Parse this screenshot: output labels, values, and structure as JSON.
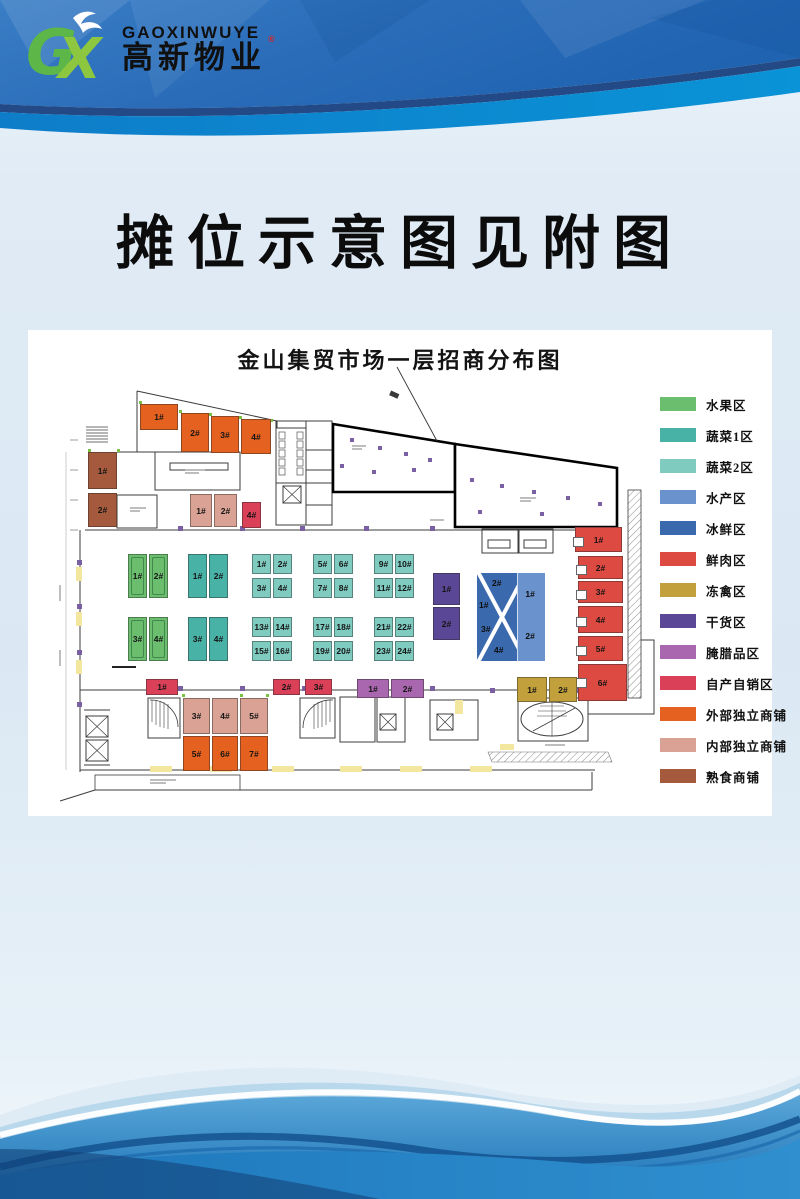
{
  "header": {
    "brand_en": "GAOXINWUYE",
    "brand_cn": "高新物业",
    "trademark": "®"
  },
  "page_title": "摊位示意图见附图",
  "plan": {
    "title": "金山集贸市场一层招商分布图",
    "zones": {
      "fruit": {
        "name": "水果区",
        "color": "#6cbe6f",
        "stalls": [
          "1#",
          "2#",
          "3#",
          "4#"
        ]
      },
      "veg1": {
        "name": "蔬菜1区",
        "color": "#49b2a6",
        "stalls": [
          "1#",
          "2#",
          "3#",
          "4#"
        ]
      },
      "veg2": {
        "name": "蔬菜2区",
        "color": "#7fcbc0",
        "stalls": [
          "1#",
          "2#",
          "3#",
          "4#",
          "5#",
          "6#",
          "7#",
          "8#",
          "9#",
          "10#",
          "11#",
          "12#",
          "13#",
          "14#",
          "15#",
          "16#",
          "17#",
          "18#",
          "19#",
          "20#",
          "21#",
          "22#",
          "23#",
          "24#"
        ]
      },
      "aquatic": {
        "name": "水产区",
        "color": "#6a93cd",
        "stalls": [
          "1#",
          "2#"
        ]
      },
      "icefresh": {
        "name": "冰鲜区",
        "color": "#3b69ad",
        "stalls": [
          "1#",
          "2#",
          "3#",
          "4#"
        ]
      },
      "meat": {
        "name": "鲜肉区",
        "color": "#dd4a41",
        "stalls": [
          "1#",
          "2#",
          "3#",
          "4#",
          "5#",
          "6#"
        ]
      },
      "poultry": {
        "name": "冻禽区",
        "color": "#c2a13c",
        "stalls": [
          "1#",
          "2#"
        ]
      },
      "dry": {
        "name": "干货区",
        "color": "#5a4795",
        "stalls": [
          "1#",
          "2#"
        ]
      },
      "cured": {
        "name": "腌腊品区",
        "color": "#a867ae",
        "stalls": [
          "1#",
          "2#"
        ]
      },
      "self": {
        "name": "自产自销区",
        "color": "#da4057",
        "stalls": [
          "1#",
          "2#",
          "3#",
          "4#"
        ]
      },
      "ext": {
        "name": "外部独立商铺",
        "color": "#e4611f",
        "stalls": [
          "1#",
          "2#",
          "3#",
          "4#",
          "5#",
          "6#",
          "7#"
        ]
      },
      "int": {
        "name": "内部独立商铺",
        "color": "#d9a294",
        "stalls": [
          "1#",
          "2#",
          "3#",
          "4#",
          "5#"
        ]
      },
      "cooked": {
        "name": "熟食商铺",
        "color": "#a55a3d",
        "stalls": [
          "1#",
          "2#"
        ]
      }
    }
  },
  "legend": {
    "items": [
      {
        "label": "水果区",
        "color": "#6cbe6f"
      },
      {
        "label": "蔬菜1区",
        "color": "#49b2a6"
      },
      {
        "label": "蔬菜2区",
        "color": "#7fcbc0"
      },
      {
        "label": "水产区",
        "color": "#6a93cd"
      },
      {
        "label": "冰鲜区",
        "color": "#3b69ad"
      },
      {
        "label": "鲜肉区",
        "color": "#dd4a41"
      },
      {
        "label": "冻禽区",
        "color": "#c2a13c"
      },
      {
        "label": "干货区",
        "color": "#5a4795"
      },
      {
        "label": "腌腊品区",
        "color": "#a867ae"
      },
      {
        "label": "自产自销区",
        "color": "#da4057"
      },
      {
        "label": "外部独立商铺",
        "color": "#e4611f"
      },
      {
        "label": "内部独立商铺",
        "color": "#d9a294"
      },
      {
        "label": "熟食商铺",
        "color": "#a55a3d"
      }
    ]
  }
}
